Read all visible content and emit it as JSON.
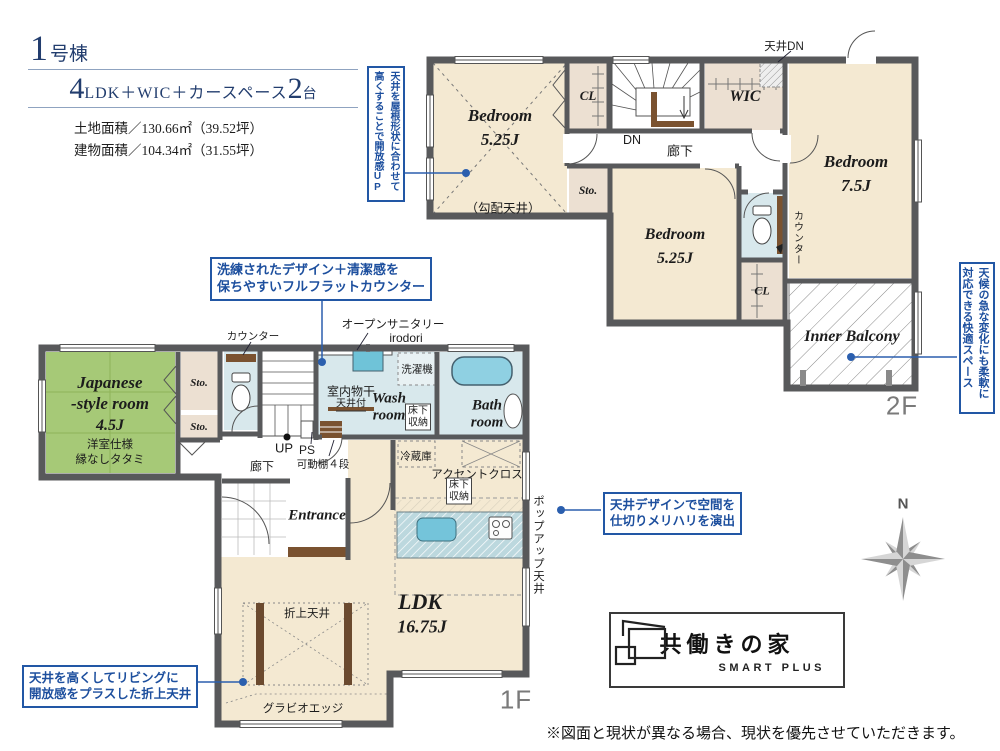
{
  "header": {
    "building_num": "1",
    "building_unit": "号棟",
    "plan_num1": "4",
    "plan_text1": "LDK＋WIC＋カースペース",
    "plan_num2": "2",
    "plan_text2": "台",
    "land_area": "土地面積／130.66㎡（39.52坪）",
    "building_area": "建物面積／104.34㎡（31.55坪）"
  },
  "annotations": {
    "sloped_ceiling_1": "天井を屋根形状に合わせて",
    "sloped_ceiling_2": "高くすることで開放感UP",
    "flat_counter_1": "洗練されたデザイン＋清潔感を",
    "flat_counter_2": "保ちやすいフルフラットカウンター",
    "balcony_1": "天候の急な変化にも柔軟に",
    "balcony_2": "対応できる快適スペース",
    "ceiling_design_1": "天井デザインで空間を",
    "ceiling_design_2": "仕切りメリハリを演出",
    "coffered_1": "天井を高くしてリビングに",
    "coffered_2": "開放感をプラスした折上天井"
  },
  "floor2": {
    "label": "2F",
    "bedroom1_name": "Bedroom",
    "bedroom1_size": "5.25J",
    "bedroom1_note": "（勾配天井）",
    "cl1": "CL",
    "dn": "DN",
    "corridor": "廊下",
    "ceiling_dn": "天井DN",
    "wic": "WIC",
    "sto": "Sto.",
    "bedroom2_name": "Bedroom",
    "bedroom2_size": "5.25J",
    "bedroom3_name": "Bedroom",
    "bedroom3_size": "7.5J",
    "counter": "カウンター",
    "cl2": "CL",
    "inner_balcony": "Inner Balcony"
  },
  "floor1": {
    "label": "1F",
    "jroom_name1": "Japanese",
    "jroom_name2": "-style room",
    "jroom_size": "4.5J",
    "jroom_note1": "洋室仕様",
    "jroom_note2": "縁なしタタミ",
    "sto1": "Sto.",
    "sto2": "Sto.",
    "counter": "カウンター",
    "up": "UP",
    "ps": "PS",
    "shelf": "可動棚４段",
    "corridor": "廊下",
    "entrance": "Entrance",
    "open_sanitary": "オープンサニタリー",
    "open_sanitary_sub": "irodori",
    "drying": "室内物干",
    "drying_sub": "天井付",
    "washer": "洗濯機",
    "wash_name1": "Wash",
    "wash_name2": "room",
    "underfloor1": "床下\n収納",
    "bath_name1": "Bath",
    "bath_name2": "room",
    "fridge": "冷蔵庫",
    "accent": "アクセントクロス",
    "underfloor2": "床下\n収納",
    "popup": "ポップアップ天井",
    "ldk_name": "LDK",
    "ldk_size": "16.75J",
    "coffered": "折上天井",
    "gravio": "グラビオエッジ"
  },
  "logo": {
    "name": "共働きの家",
    "sub": "SMART PLUS"
  },
  "compass": {
    "n": "N"
  },
  "footer": {
    "disclaimer": "※図面と現状が異なる場合、現状を優先させていただきます。"
  }
}
